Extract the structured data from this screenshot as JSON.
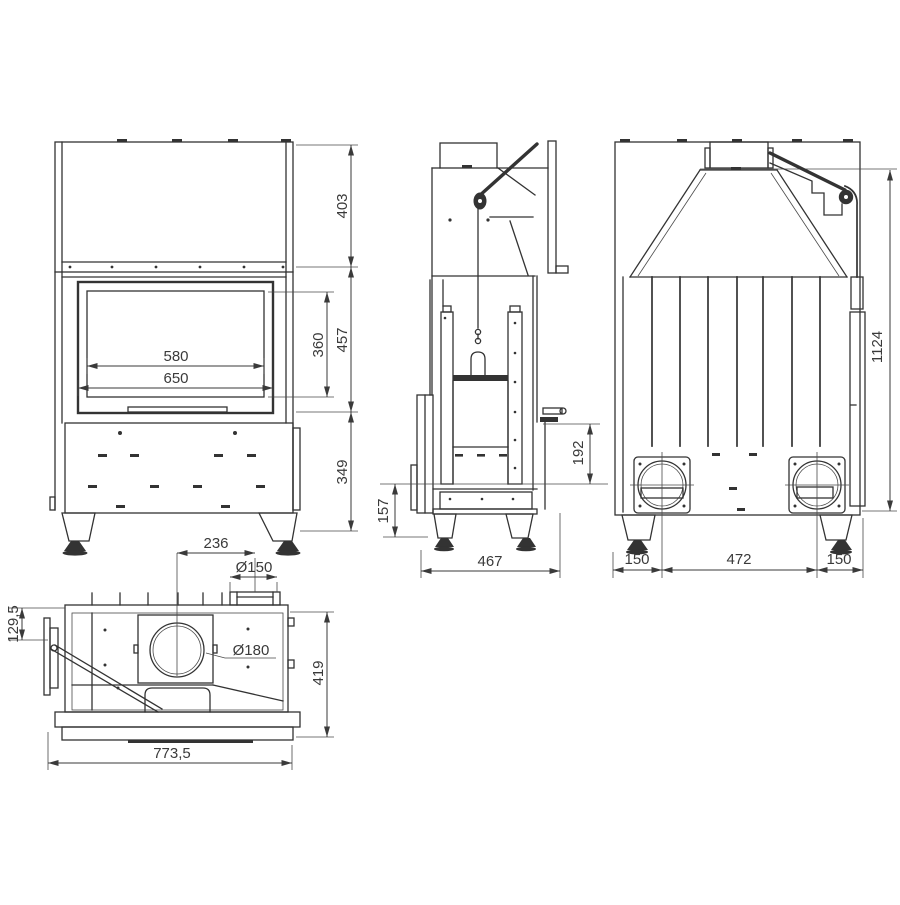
{
  "colors": {
    "background": "#ffffff",
    "line": "#333333",
    "dimension": "#3a3a3a"
  },
  "views": {
    "front": {
      "dimensions": {
        "hood_height": "403",
        "firebox_height": "457",
        "base_height": "349",
        "glass_width": "580",
        "door_width": "650",
        "glass_height": "360"
      }
    },
    "side": {
      "dimensions": {
        "rear_ledge_height": "192",
        "plinth_height": "157",
        "depth": "467"
      }
    },
    "rear": {
      "dimensions": {
        "total_height": "1124",
        "left_inlet_offset": "150",
        "inlet_spacing": "472",
        "right_inlet_offset": "150"
      }
    },
    "top": {
      "dimensions": {
        "flue_center_offset": "236",
        "intake_diameter": "Ø150",
        "flue_diameter": "Ø180",
        "front_ledge_depth": "129,5",
        "depth": "419",
        "overall_width": "773,5"
      }
    }
  }
}
